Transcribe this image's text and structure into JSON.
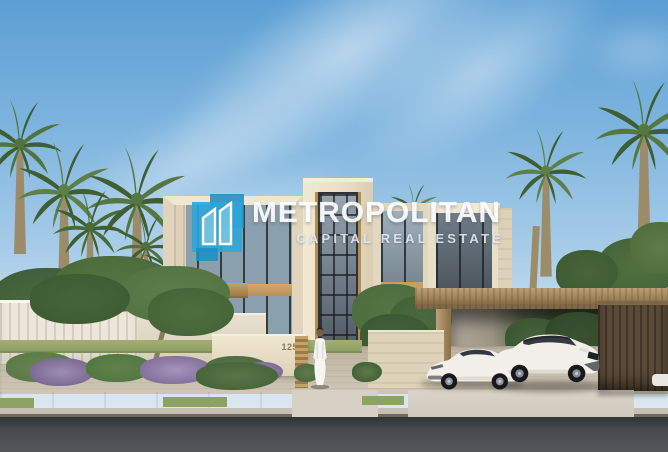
{
  "watermark": {
    "brand": "METROPOLITAN",
    "tagline": "CAPITAL REAL ESTATE",
    "logo_icon": "metropolitan-twin-towers-icon"
  },
  "villa": {
    "house_number": "125"
  },
  "colors": {
    "brand_blue": "#2fa6d8",
    "brand_blue_dark": "#1e8ec4",
    "sky_top": "#5c9fd3",
    "sky_horizon": "#e0eaf1",
    "facade_beige": "#e5dbc3",
    "wood_tan": "#c49e66",
    "carport_brown": "#9a7d52",
    "carport_wall_brown": "#5a4a37",
    "glass_dark": "#4d5760",
    "foliage_green": "#557a43",
    "shrub_purple": "#9d8cb4",
    "pavement": "#c2b7a5",
    "road_asphalt": "#45494d",
    "car_white": "#f2f0ea"
  }
}
